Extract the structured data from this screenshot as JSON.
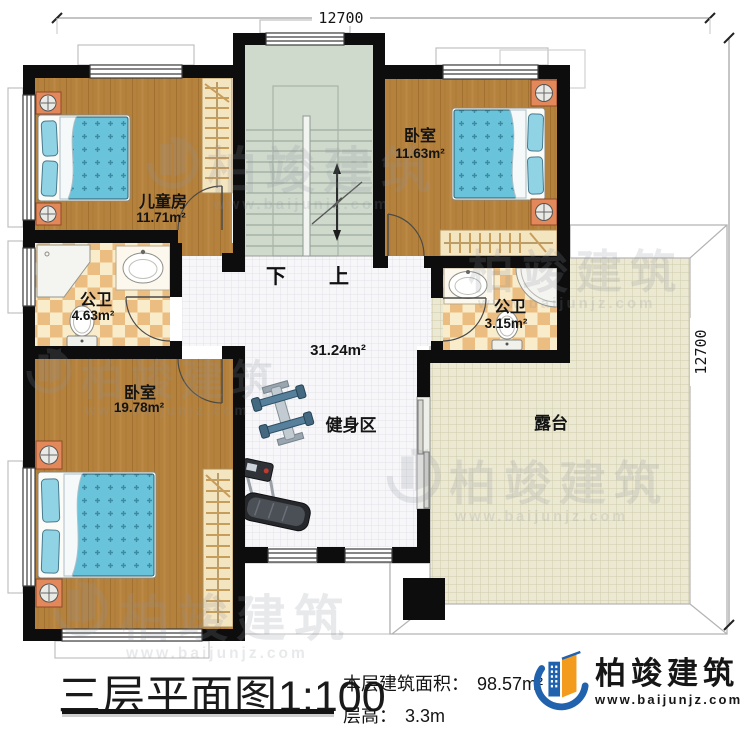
{
  "dimensions": {
    "top": "12700",
    "right": "12700"
  },
  "rooms": {
    "children_room": {
      "name": "儿童房",
      "area": "11.71m²"
    },
    "bedroom_top_right": {
      "name": "卧室",
      "area": "11.63m²"
    },
    "bath_left": {
      "name": "公卫",
      "area": "4.63m²"
    },
    "bath_right": {
      "name": "公卫",
      "area": "3.15m²"
    },
    "bedroom_bottom_left": {
      "name": "卧室",
      "area": "19.78m²"
    },
    "hall": {
      "area": "31.24m²"
    },
    "gym": {
      "name": "健身区"
    },
    "terrace": {
      "name": "露台"
    }
  },
  "stairs": {
    "down_label": "下",
    "up_label": "上"
  },
  "title_block": {
    "plan_title": "三层平面图",
    "scale": "1:100",
    "area_label": "本层建筑面积：",
    "area_value": "98.57m²",
    "height_label": "层高：",
    "height_value": "3.3m"
  },
  "brand": {
    "name": "柏竣建筑",
    "website": "www.baijunjz.com"
  },
  "watermark": {
    "text": "柏竣建筑",
    "url": "www.baijunjz.com"
  },
  "colors": {
    "wall": "#0d0d0d",
    "wood_floor": "#b5823e",
    "bed_blue": "#69c3da",
    "stair_green": "#cfdacd",
    "bath_tile_light": "#f9ecca",
    "bath_tile_dark": "#ecbd80",
    "terrace_floor": "#ece9d3",
    "brand_blue": "#2062ae",
    "brand_orange": "#f29b1d"
  }
}
